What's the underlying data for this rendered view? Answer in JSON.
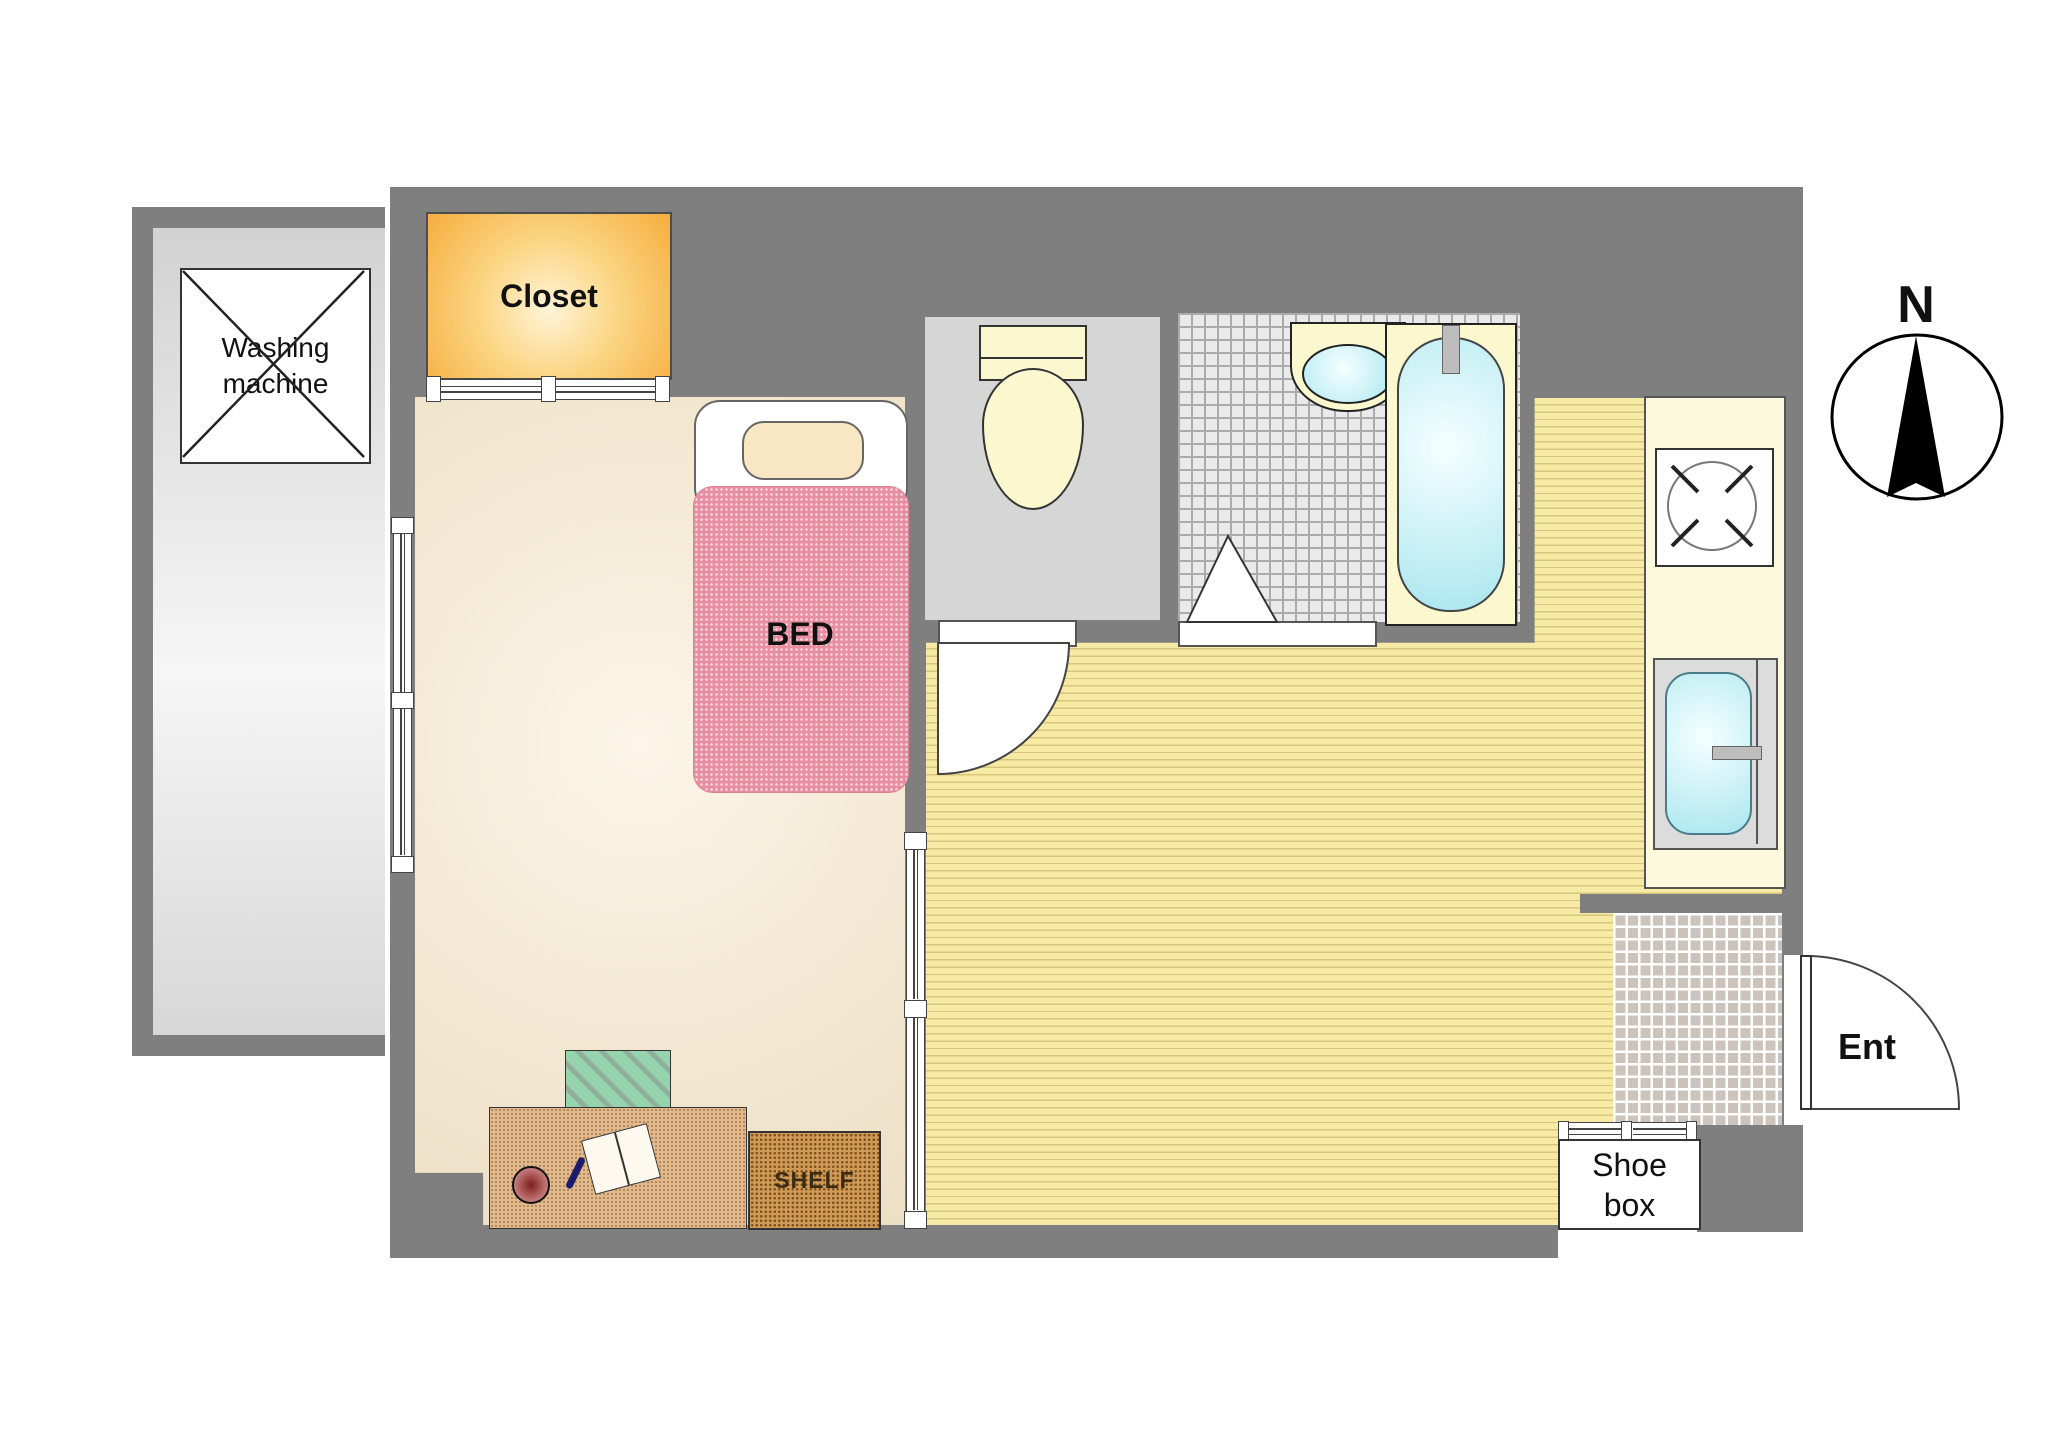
{
  "title": "Studio apartment floor plan",
  "labels": {
    "washing_line1": "Washing",
    "washing_line2": "machine",
    "closet": "Closet",
    "bed": "BED",
    "shelf": "SHELF",
    "shoe_line1": "Shoe",
    "shoe_line2": "box",
    "ent": "Ent",
    "north": "N"
  },
  "rooms": [
    {
      "name": "balcony",
      "feature": "washing machine pad"
    },
    {
      "name": "bedroom",
      "features": [
        "closet",
        "bed",
        "desk",
        "chair",
        "shelf",
        "windows"
      ]
    },
    {
      "name": "toilet-room",
      "features": [
        "toilet"
      ]
    },
    {
      "name": "bathroom",
      "features": [
        "vanity sink",
        "bathtub",
        "stool"
      ]
    },
    {
      "name": "kitchen",
      "features": [
        "stove",
        "kitchen sink",
        "counter"
      ]
    },
    {
      "name": "entrance",
      "features": [
        "shoe box",
        "entry door",
        "tiled genkan"
      ]
    }
  ],
  "colors": {
    "wall_gray": "#7f7f7f",
    "balcony_gray": "#dedede",
    "closet_orange": "#f6ad3e",
    "bedroom_beige": "#f2e5cc",
    "living_yellow": "#f7eaa4",
    "mattress_pink": "#e78fa0",
    "fixture_cream": "#fbf8cf",
    "water_cyan": "#a9e6ef",
    "counter_cream": "#fcf9dc",
    "desk_tan": "#e0b98c",
    "shelf_brown": "#cf9a55",
    "chair_green": "#96d4ae",
    "genkan_tile": "#cdc3bd"
  },
  "compass": {
    "direction": "N",
    "arrow": "up"
  }
}
